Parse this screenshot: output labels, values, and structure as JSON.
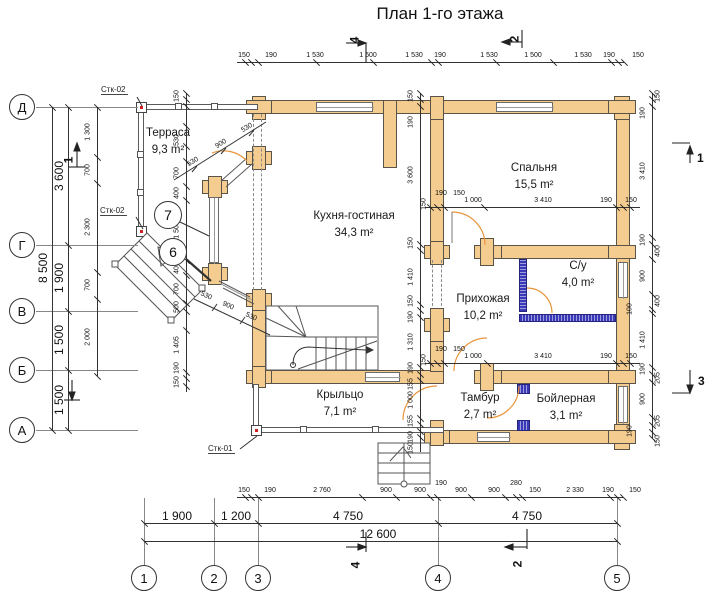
{
  "title": "План 1-го этажа",
  "rooms": [
    {
      "name": "Терраса",
      "area": "9,3 m²",
      "x": 168,
      "y": 127
    },
    {
      "name": "Кухня-гостиная",
      "area": "34,3 m²",
      "x": 354,
      "y": 210
    },
    {
      "name": "Спальня",
      "area": "15,5 m²",
      "x": 534,
      "y": 162
    },
    {
      "name": "С/у",
      "area": "4,0 m²",
      "x": 578,
      "y": 260
    },
    {
      "name": "Прихожая",
      "area": "10,2 m²",
      "x": 483,
      "y": 293
    },
    {
      "name": "Крыльцо",
      "area": "7,1 m²",
      "x": 340,
      "y": 389
    },
    {
      "name": "Тамбур",
      "area": "2,7 m²",
      "x": 480,
      "y": 392
    },
    {
      "name": "Бойлерная",
      "area": "3,1 m²",
      "x": 566,
      "y": 393
    }
  ],
  "axes_left": [
    {
      "label": "Д",
      "y": 107
    },
    {
      "label": "Г",
      "y": 245
    },
    {
      "label": "В",
      "y": 311
    },
    {
      "label": "Б",
      "y": 370
    },
    {
      "label": "А",
      "y": 430
    }
  ],
  "axes_bottom": [
    {
      "label": "1",
      "x": 144
    },
    {
      "label": "2",
      "x": 214
    },
    {
      "label": "3",
      "x": 258
    },
    {
      "label": "4",
      "x": 438
    },
    {
      "label": "5",
      "x": 617
    }
  ],
  "stamps": [
    {
      "text": "Стк-02",
      "x": 101,
      "y": 85
    },
    {
      "text": "Стк-02",
      "x": 100,
      "y": 206
    },
    {
      "text": "Стк-01",
      "x": 208,
      "y": 444
    }
  ],
  "callouts": [
    {
      "num": "7",
      "x": 168,
      "y": 215
    },
    {
      "num": "6",
      "x": 173,
      "y": 252
    }
  ],
  "sections": [
    {
      "num": "4",
      "x": 351,
      "y": 33,
      "rot": true
    },
    {
      "num": "2",
      "x": 511,
      "y": 32,
      "rot": true
    },
    {
      "num": "4",
      "x": 352,
      "y": 558,
      "rot": true
    },
    {
      "num": "2",
      "x": 514,
      "y": 557,
      "rot": true
    },
    {
      "num": "1",
      "x": 65,
      "y": 153,
      "rot": true
    },
    {
      "num": "1",
      "x": 697,
      "y": 151,
      "rot": false
    },
    {
      "num": "3",
      "x": 698,
      "y": 374,
      "rot": false
    }
  ],
  "chains": [
    {
      "id": "top-outer",
      "o": "h",
      "c": 62,
      "a": 237,
      "b": 624,
      "ticks": [
        245,
        251,
        258,
        316,
        373,
        431,
        438,
        496,
        553,
        611,
        618,
        624
      ],
      "labels": [
        {
          "t": "150",
          "p": 244
        },
        {
          "t": "190",
          "p": 271
        },
        {
          "t": "1 530",
          "p": 315
        },
        {
          "t": "1 500",
          "p": 368
        },
        {
          "t": "1 530",
          "p": 414
        },
        {
          "t": "190",
          "p": 440
        },
        {
          "t": "1 530",
          "p": 489
        },
        {
          "t": "1 500",
          "p": 533
        },
        {
          "t": "1 530",
          "p": 583
        },
        {
          "t": "190",
          "p": 609
        },
        {
          "t": "150",
          "p": 638
        }
      ]
    },
    {
      "id": "bottom-inner",
      "o": "h",
      "c": 497,
      "a": 237,
      "b": 623,
      "ticks": [
        245,
        251,
        258,
        362,
        396,
        430,
        437,
        471,
        505,
        516,
        522,
        610,
        617,
        623
      ],
      "labels": [
        {
          "t": "150",
          "p": 244
        },
        {
          "t": "190",
          "p": 270
        },
        {
          "t": "2 760",
          "p": 322
        },
        {
          "t": "900",
          "p": 386
        },
        {
          "t": "900",
          "p": 420
        },
        {
          "t": "190",
          "p": 441,
          "off": -17
        },
        {
          "t": "900",
          "p": 461
        },
        {
          "t": "900",
          "p": 494
        },
        {
          "t": "280",
          "p": 516,
          "off": -17
        },
        {
          "t": "150",
          "p": 535
        },
        {
          "t": "2 330",
          "p": 575
        },
        {
          "t": "190",
          "p": 608
        },
        {
          "t": "150",
          "p": 635
        }
      ]
    },
    {
      "id": "bottom-axes",
      "o": "h",
      "c": 523,
      "a": 144,
      "b": 617,
      "fs": 12,
      "ticks": [
        144,
        214,
        258,
        438,
        617
      ],
      "labels": [
        {
          "t": "1 900",
          "p": 177,
          "off": -14
        },
        {
          "t": "1 200",
          "p": 236,
          "off": -14
        },
        {
          "t": "4 750",
          "p": 348,
          "off": -14
        },
        {
          "t": "4 750",
          "p": 527,
          "off": -14
        }
      ]
    },
    {
      "id": "bottom-total",
      "o": "h",
      "c": 541,
      "a": 144,
      "b": 617,
      "fs": 12,
      "ticks": [
        144,
        617
      ],
      "labels": [
        {
          "t": "12 600",
          "p": 378,
          "off": -14
        }
      ]
    },
    {
      "id": "left-total",
      "o": "v",
      "c": 52,
      "a": 107,
      "b": 430,
      "fs": 12,
      "ticks": [
        107,
        430
      ],
      "labels": [
        {
          "t": "8 500",
          "p": 268
        }
      ]
    },
    {
      "id": "left-axes",
      "o": "v",
      "c": 68,
      "a": 107,
      "b": 430,
      "fs": 12,
      "ticks": [
        107,
        245,
        311,
        370,
        430
      ],
      "labels": [
        {
          "t": "3 600",
          "p": 176
        },
        {
          "t": "1 900",
          "p": 278
        },
        {
          "t": "1 500",
          "p": 340
        },
        {
          "t": "1 500",
          "p": 400
        }
      ]
    },
    {
      "id": "left-inner",
      "o": "v",
      "c": 97,
      "a": 107,
      "b": 376,
      "ticks": [
        107,
        157,
        183,
        272,
        299,
        376
      ],
      "labels": [
        {
          "t": "1 300",
          "p": 132
        },
        {
          "t": "700",
          "p": 170
        },
        {
          "t": "2 300",
          "p": 227
        },
        {
          "t": "700",
          "p": 285
        },
        {
          "t": "2 000",
          "p": 337
        }
      ]
    },
    {
      "id": "right-inner",
      "o": "v",
      "c": 652,
      "a": 93,
      "b": 438,
      "ticks": [
        93,
        99,
        106,
        237,
        244,
        259,
        294,
        309,
        313,
        367,
        374,
        382,
        417,
        425,
        432,
        438
      ],
      "labels": [
        {
          "t": "150",
          "p": 96,
          "off": 15
        },
        {
          "t": "190",
          "p": 113
        },
        {
          "t": "3 410",
          "p": 171
        },
        {
          "t": "190",
          "p": 240
        },
        {
          "t": "400",
          "p": 251,
          "off": 15
        },
        {
          "t": "900",
          "p": 276
        },
        {
          "t": "400",
          "p": 301,
          "off": 15
        },
        {
          "t": "100",
          "p": 309,
          "off": -13
        },
        {
          "t": "1 410",
          "p": 340
        },
        {
          "t": "190",
          "p": 369
        },
        {
          "t": "205",
          "p": 378,
          "off": 15
        },
        {
          "t": "900",
          "p": 399
        },
        {
          "t": "205",
          "p": 421,
          "off": 15
        },
        {
          "t": "190",
          "p": 431,
          "off": -13
        },
        {
          "t": "150",
          "p": 441,
          "off": 15
        }
      ]
    },
    {
      "id": "grid4-chain",
      "o": "v",
      "c": 420,
      "a": 93,
      "b": 452,
      "ticks": [
        93,
        99,
        106,
        244,
        250,
        304,
        310,
        317,
        367,
        374,
        380,
        418,
        424,
        431,
        437
      ],
      "labels": [
        {
          "t": "150",
          "p": 96
        },
        {
          "t": "190",
          "p": 122
        },
        {
          "t": "3 600",
          "p": 175
        },
        {
          "t": "150",
          "p": 243
        },
        {
          "t": "1 410",
          "p": 277
        },
        {
          "t": "150",
          "p": 301
        },
        {
          "t": "190",
          "p": 317
        },
        {
          "t": "1 310",
          "p": 342
        },
        {
          "t": "190",
          "p": 368
        },
        {
          "t": "155",
          "p": 384
        },
        {
          "t": "1 000",
          "p": 400
        },
        {
          "t": "155",
          "p": 421
        },
        {
          "t": "190",
          "p": 437
        },
        {
          "t": "150",
          "p": 448
        }
      ]
    },
    {
      "id": "terrace-chain",
      "o": "v",
      "c": 186,
      "a": 93,
      "b": 392,
      "ticks": [
        93,
        99,
        106,
        126,
        146,
        161,
        186,
        200,
        260,
        275,
        303,
        311,
        330,
        372,
        378,
        386
      ],
      "labels": [
        {
          "t": "150",
          "p": 96
        },
        {
          "t": "530",
          "p": 140
        },
        {
          "t": "700",
          "p": 173
        },
        {
          "t": "400",
          "p": 193
        },
        {
          "t": "1 500",
          "p": 230
        },
        {
          "t": "400",
          "p": 268
        },
        {
          "t": "700",
          "p": 289
        },
        {
          "t": "500",
          "p": 307
        },
        {
          "t": "1 405",
          "p": 345
        },
        {
          "t": "190",
          "p": 368
        },
        {
          "t": "150",
          "p": 382
        }
      ]
    },
    {
      "id": "bedroom-door-dim",
      "o": "h",
      "c": 207,
      "a": 425,
      "b": 640,
      "ticks": [
        430,
        437,
        444,
        484,
        616,
        623,
        630
      ],
      "labels": [
        {
          "t": "150",
          "p": 424,
          "rot": true,
          "off": -3
        },
        {
          "t": "190",
          "p": 441,
          "off": -17
        },
        {
          "t": "150",
          "p": 459,
          "off": -17
        },
        {
          "t": "1 000",
          "p": 473
        },
        {
          "t": "3 410",
          "p": 543
        },
        {
          "t": "190",
          "p": 606
        },
        {
          "t": "150",
          "p": 631
        }
      ]
    },
    {
      "id": "tambour-door-dim",
      "o": "h",
      "c": 363,
      "a": 425,
      "b": 640,
      "ticks": [
        430,
        437,
        444,
        487,
        616,
        623,
        630
      ],
      "labels": [
        {
          "t": "150",
          "p": 424,
          "rot": true,
          "off": -3
        },
        {
          "t": "190",
          "p": 441,
          "off": -17
        },
        {
          "t": "150",
          "p": 459,
          "off": -17
        },
        {
          "t": "1 000",
          "p": 473
        },
        {
          "t": "3 410",
          "p": 543
        },
        {
          "t": "190",
          "p": 606
        },
        {
          "t": "150",
          "p": 631
        }
      ]
    }
  ],
  "diag_labels": [
    {
      "t": "530",
      "x": 193,
      "y": 162,
      "r": -32
    },
    {
      "t": "900",
      "x": 221,
      "y": 144,
      "r": -32
    },
    {
      "t": "530",
      "x": 247,
      "y": 128,
      "r": -32
    },
    {
      "t": "530",
      "x": 206,
      "y": 296,
      "r": 25
    },
    {
      "t": "900",
      "x": 228,
      "y": 306,
      "r": 25
    },
    {
      "t": "530",
      "x": 251,
      "y": 317,
      "r": 25
    }
  ]
}
